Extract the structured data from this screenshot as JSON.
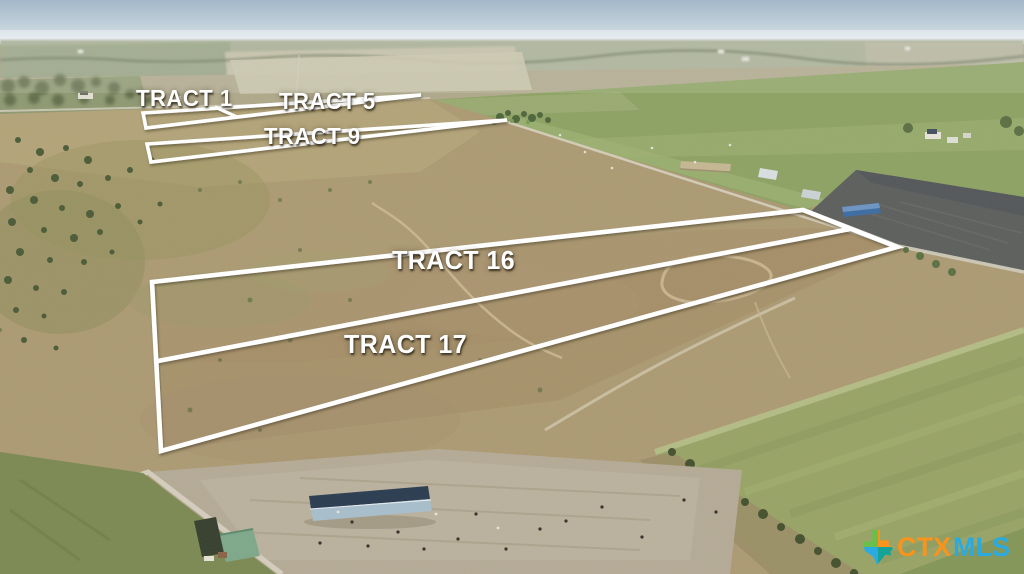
{
  "tracts": {
    "tract1": {
      "label": "TRACT 1"
    },
    "tract5": {
      "label": "TRACT 5"
    },
    "tract9": {
      "label": "TRACT 9"
    },
    "tract16": {
      "label": "TRACT 16"
    },
    "tract17": {
      "label": "TRACT 17"
    }
  },
  "overlay": {
    "boundary_color": "#ffffff",
    "label_color": "#ffffff"
  },
  "watermark": {
    "ctx": "CTX",
    "mls": "MLS",
    "ctx_color": "#f7941e",
    "mls_color": "#29abe2",
    "icon": "texas-map-icon",
    "icon_colors": [
      "#6abf4b",
      "#f7941e",
      "#29abe2",
      "#14a396"
    ]
  }
}
